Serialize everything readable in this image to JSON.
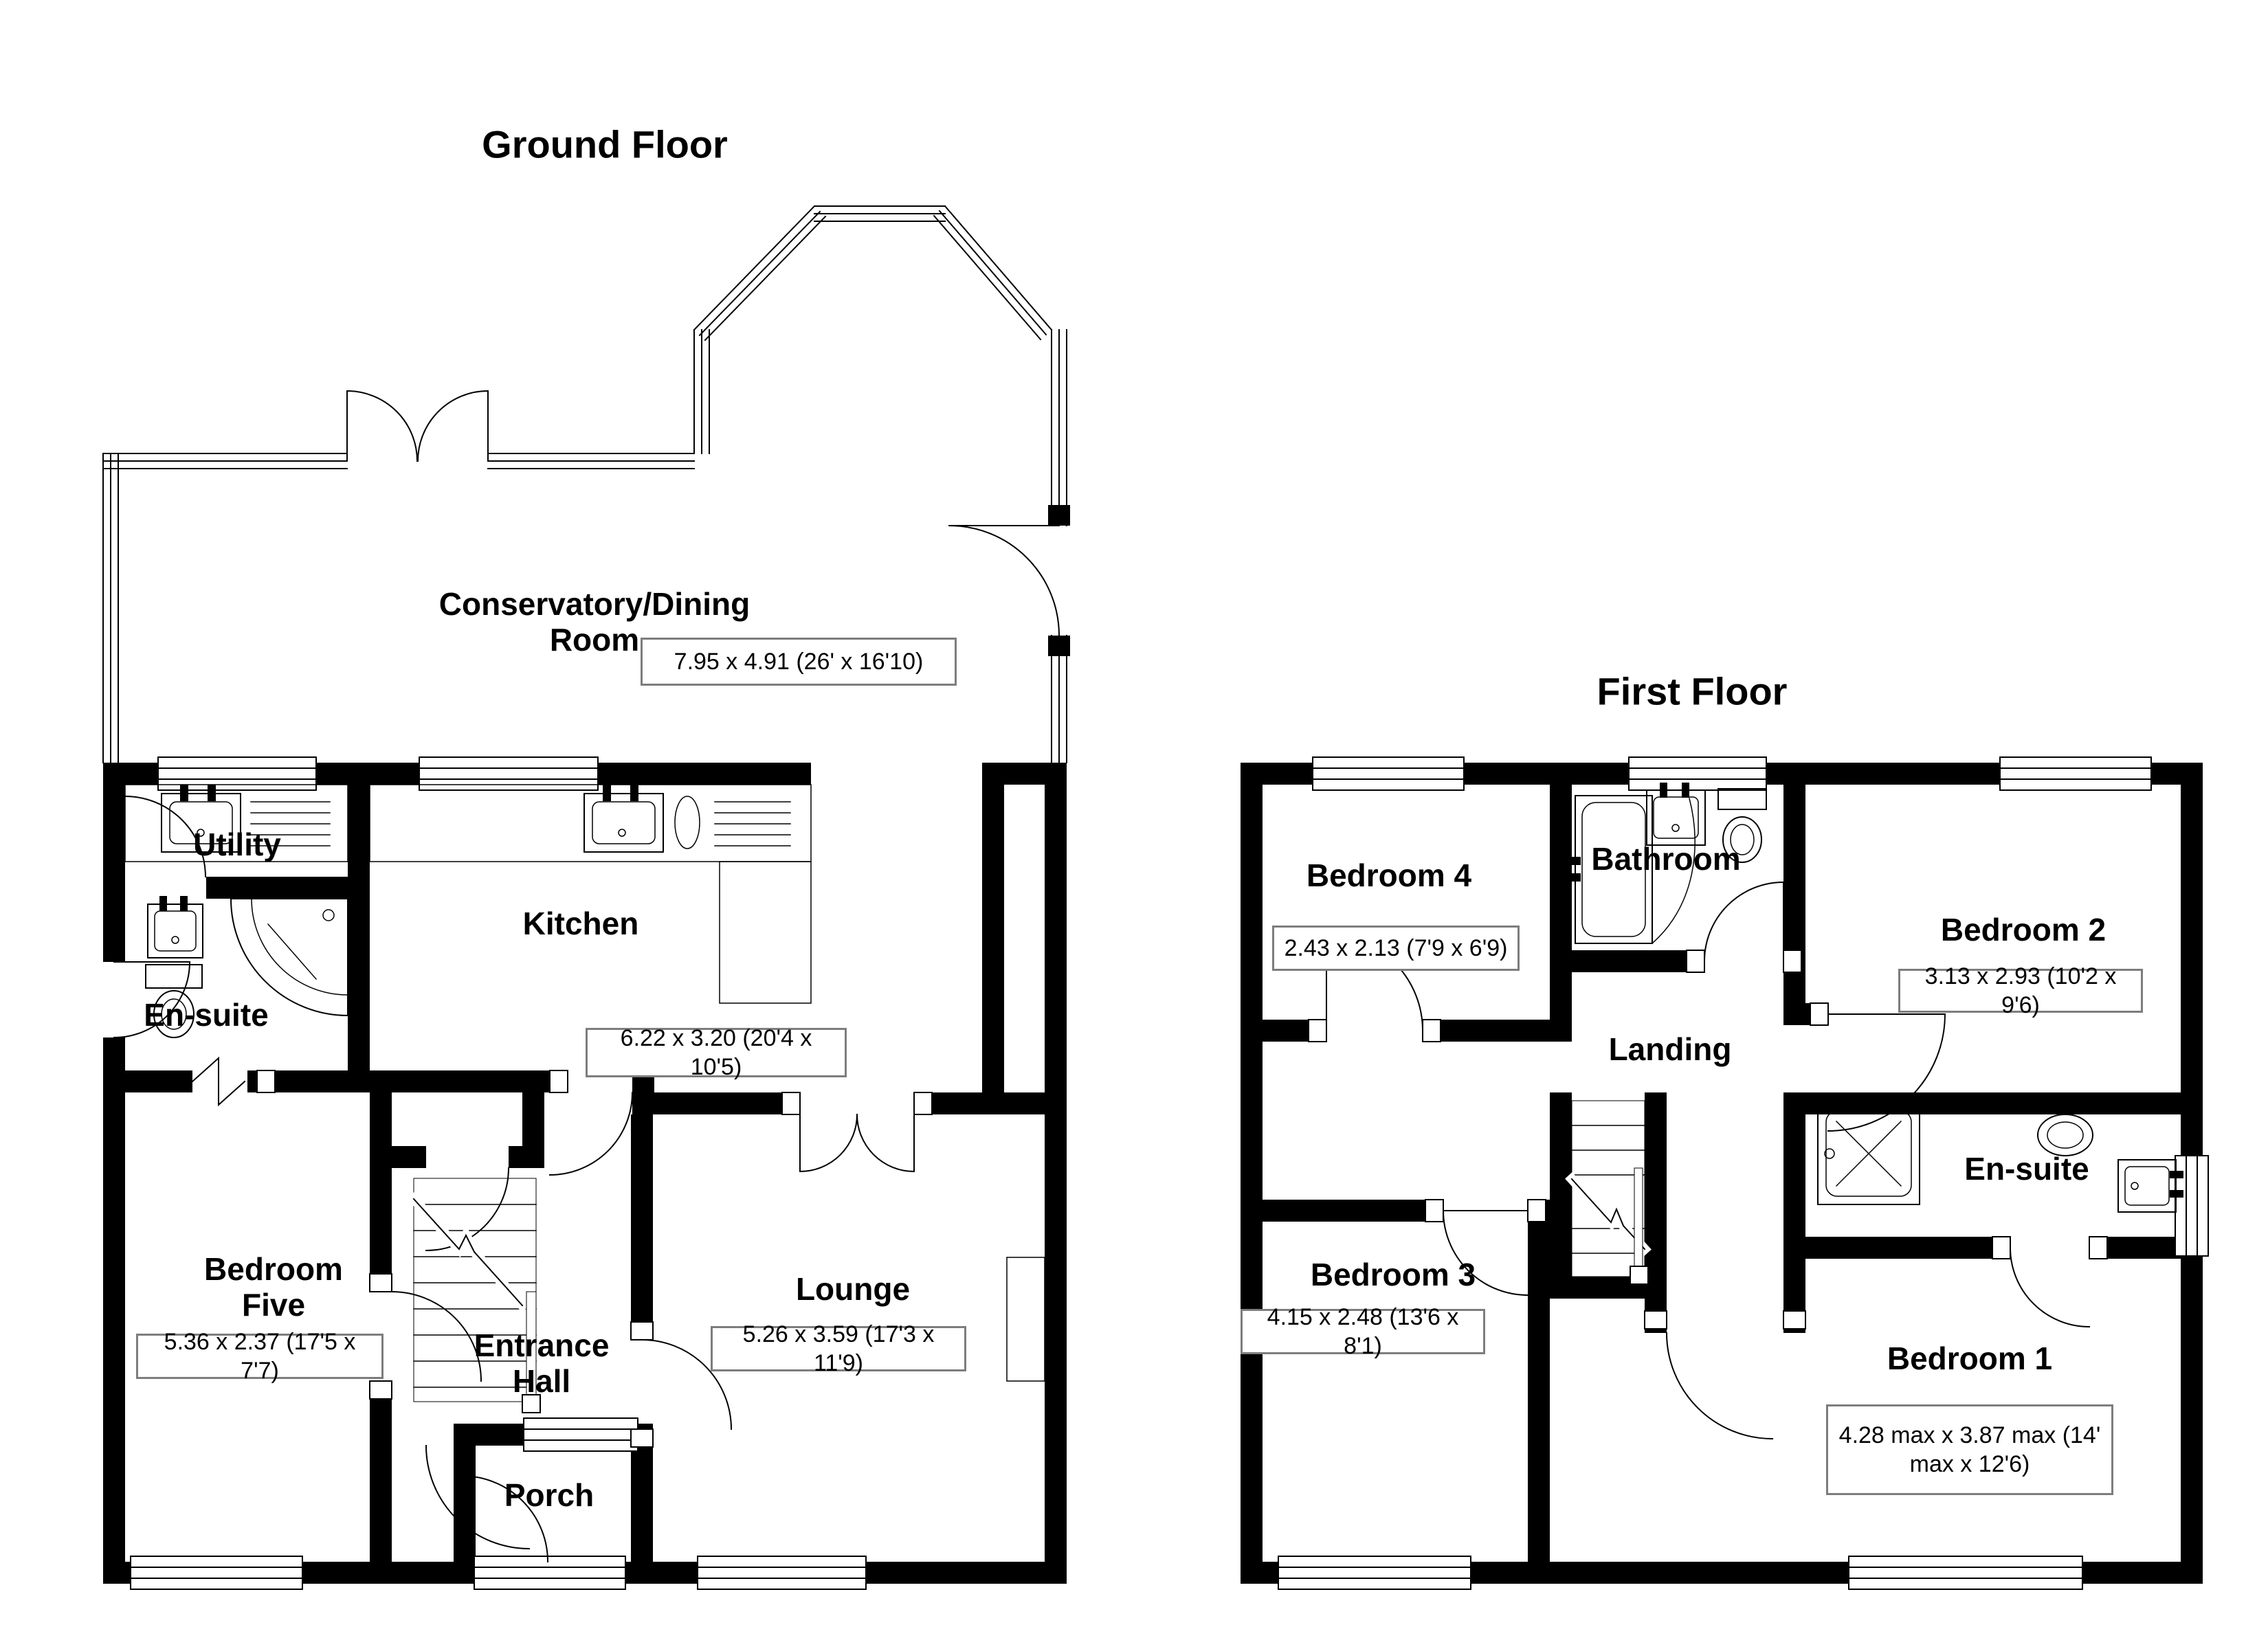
{
  "colors": {
    "wall": "#000000",
    "line": "#000000",
    "dim_border": "#7d7d7d",
    "background": "#ffffff"
  },
  "ground_floor": {
    "title": "Ground Floor",
    "rooms": [
      {
        "id": "conservatory",
        "name": "Conservatory/Dining Room",
        "name_lines": [
          "Conservatory/Dining",
          "Room"
        ],
        "dims": "7.95 x 4.91 (26' x 16'10)"
      },
      {
        "id": "utility",
        "name": "Utility"
      },
      {
        "id": "kitchen",
        "name": "Kitchen",
        "dims": "6.22 x 3.20 (20'4 x 10'5)"
      },
      {
        "id": "ensuite-ground",
        "name": "En-suite"
      },
      {
        "id": "bedroom-five",
        "name": "Bedroom Five",
        "name_lines": [
          "Bedroom",
          "Five"
        ],
        "dims": "5.36 x 2.37 (17'5 x 7'7)"
      },
      {
        "id": "entrance-hall",
        "name": "Entrance Hall",
        "name_lines": [
          "Entrance",
          "Hall"
        ]
      },
      {
        "id": "porch",
        "name": "Porch"
      },
      {
        "id": "lounge",
        "name": "Lounge",
        "dims": "5.26 x 3.59 (17'3 x 11'9)"
      }
    ]
  },
  "first_floor": {
    "title": "First Floor",
    "rooms": [
      {
        "id": "bedroom-4",
        "name": "Bedroom 4",
        "dims": "2.43 x 2.13 (7'9 x 6'9)"
      },
      {
        "id": "bathroom",
        "name": "Bathroom"
      },
      {
        "id": "bedroom-2",
        "name": "Bedroom 2",
        "dims": "3.13 x 2.93 (10'2 x 9'6)"
      },
      {
        "id": "landing",
        "name": "Landing"
      },
      {
        "id": "ensuite-first",
        "name": "En-suite"
      },
      {
        "id": "bedroom-3",
        "name": "Bedroom 3",
        "dims": "4.15 x 2.48 (13'6 x 8'1)"
      },
      {
        "id": "bedroom-1",
        "name": "Bedroom 1",
        "dims": "4.28 max x 3.87 max (14' max x 12'6)"
      }
    ]
  }
}
